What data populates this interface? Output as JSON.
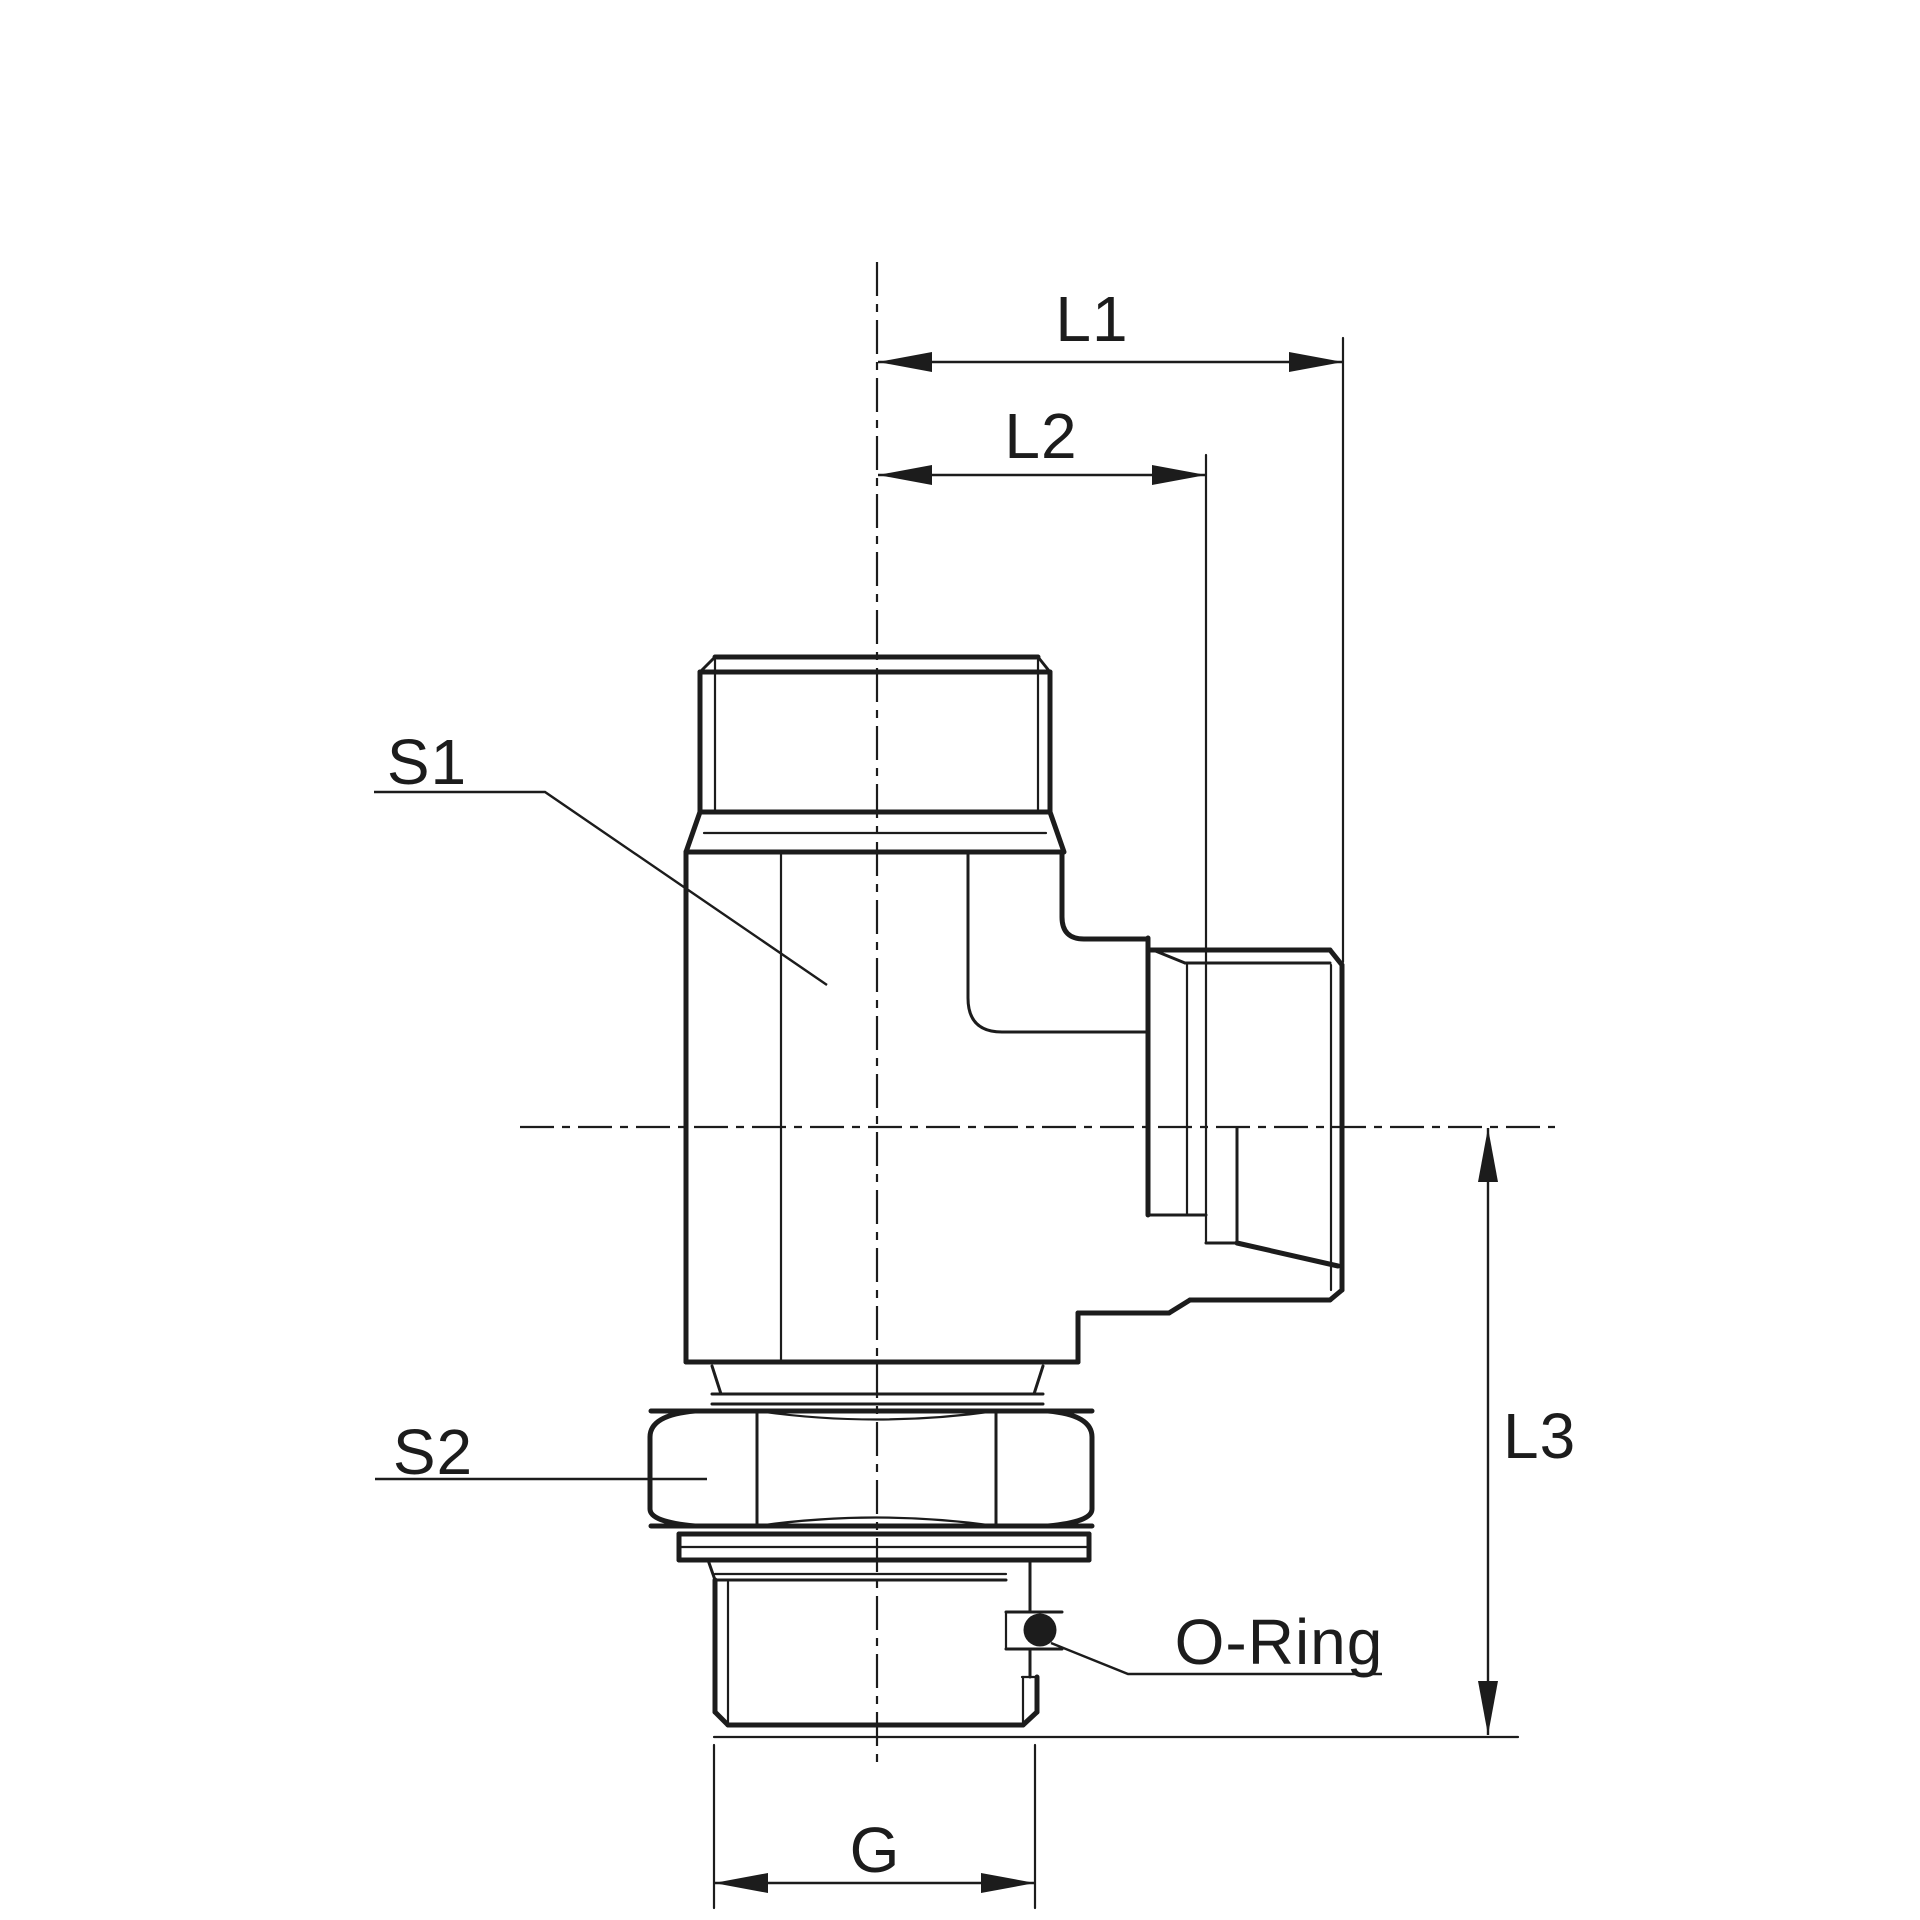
{
  "drawing": {
    "title": "L-type male stud elbow fitting - dimensioned technical drawing",
    "colors": {
      "line": "#1c1c1c",
      "background": "#ffffff"
    },
    "labels": {
      "l1": "L1",
      "l2": "L2",
      "l3": "L3",
      "s1": "S1",
      "s2": "S2",
      "g": "G",
      "oring": "O-Ring"
    }
  }
}
